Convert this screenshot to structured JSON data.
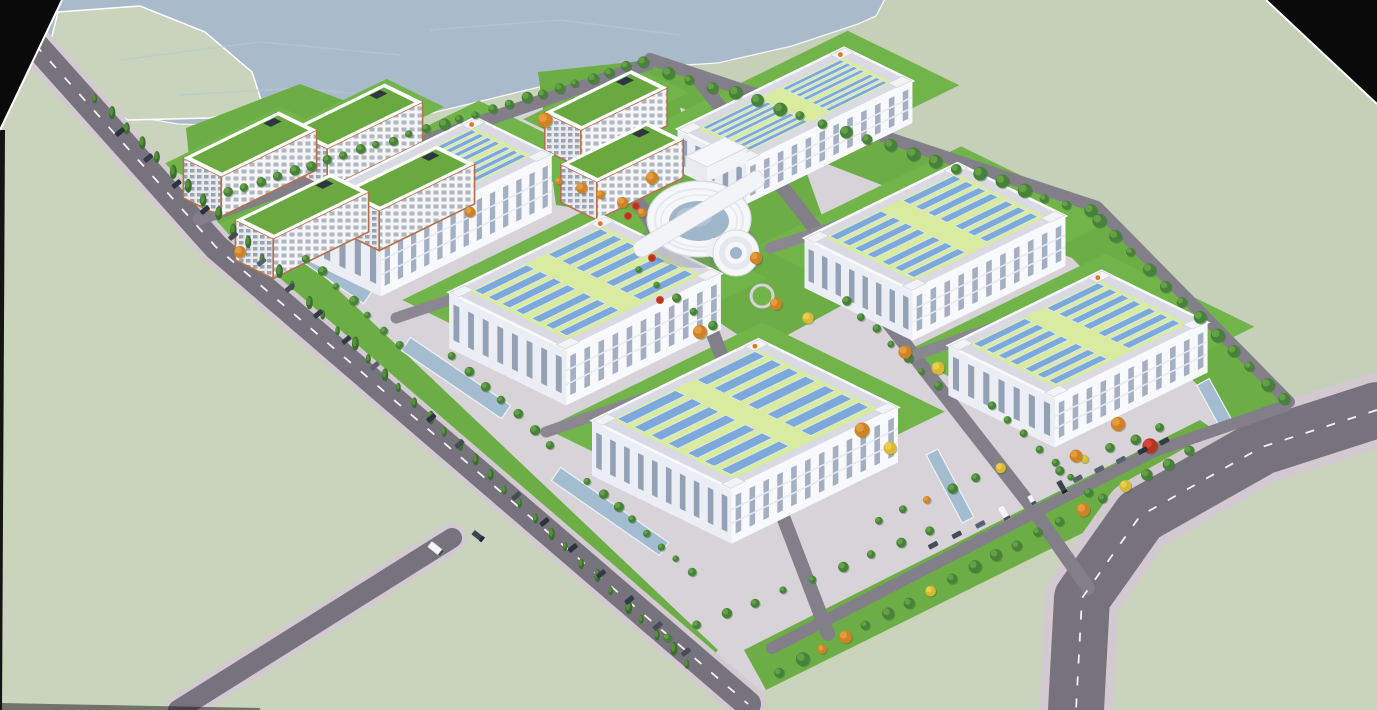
{
  "scene": {
    "description": "Aerial 3D architectural rendering of an industrial park: six white factory halls with rooftop solar arrays, dormitory blocks with green roofs, a circular hub building, tree-lined roads, water bodies and a curving highway",
    "canvas": {
      "w": 1377,
      "h": 710
    },
    "axes": {
      "u": [
        0.9,
        -0.44
      ],
      "v": [
        0.9,
        0.44
      ]
    },
    "colors": {
      "land": "#cad3bc",
      "landAlt": "#c6cfb8",
      "water": "#a9bbca",
      "ripple": "#b8c7d4",
      "shore": "#f5f7f8",
      "pavement": "#d7d3d8",
      "lawn": "#6cae45",
      "lawnBright": "#71b44a",
      "roadMain": "#76737d",
      "roadMinor": "#827f89",
      "roadLane": "#8a8791",
      "sidewalk": "#d2cad0",
      "dash": "#f2f2f4",
      "roofRim": "#d9dae3",
      "roofField": "#d9eb9e",
      "panel": "#7ca8da",
      "panelEdge": "#dce8f6",
      "wallLight": "#f8f9fc",
      "wallShade": "#eceef5",
      "windowSlit": "#9aa6bb",
      "windowSlit2": "#8b97ac",
      "parapet": "#fafafc",
      "cornerBlock": "#f2f3f7",
      "cornerEdge": "#cdd0da",
      "logoOrange": "#e07820",
      "floorBand": "#e8eaf1",
      "dormRoof": "#69a93f",
      "dormTrim": "#b5724a",
      "dormWin": "#aeb6c2",
      "dormWin2": "#9aa3b2",
      "dormWallA": "#f6f6f8",
      "dormWallB": "#e8eaf0",
      "roofUnit": "#2f3542",
      "glass": "#9fb5c8",
      "glassHi": "#b6c9da",
      "ringWhite": "#f6f7fa",
      "ringStroke": "#d5d8e2",
      "ringMid": "#e6e8ef",
      "channel": "#a4bcd0",
      "channelEdge": "#eef2f6",
      "treeGreen": "#47823a",
      "treeGreenLight": "#65a047",
      "conifer": "#3b6d2f",
      "coniferLight": "#549139",
      "orange": "#d08229",
      "orangeLight": "#e39d3c",
      "yellow": "#d9b832",
      "yellowLight": "#e7cf55",
      "red": "#b73325",
      "redLight": "#d24a33",
      "carPalette": [
        "#2c323e",
        "#454b57",
        "#5a6170",
        "#343a46"
      ],
      "truckWhite": "#f5f5f7",
      "truckDark": "#3a4150",
      "truckEdge": "#c2c4cc",
      "black": "#0a0a0a",
      "shadow": "#5a6478"
    },
    "water": {
      "outline": [
        [
          16,
          -3
        ],
        [
          886,
          -3
        ],
        [
          876,
          16
        ],
        [
          858,
          24
        ],
        [
          792,
          46
        ],
        [
          718,
          63
        ],
        [
          652,
          67
        ],
        [
          560,
          82
        ],
        [
          432,
          113
        ],
        [
          302,
          128
        ],
        [
          178,
          124
        ],
        [
          108,
          112
        ],
        [
          36,
          26
        ]
      ],
      "peninsula": [
        [
          58,
          12
        ],
        [
          140,
          6
        ],
        [
          205,
          32
        ],
        [
          252,
          72
        ],
        [
          263,
          106
        ],
        [
          210,
          118
        ],
        [
          128,
          120
        ],
        [
          80,
          96
        ],
        [
          48,
          52
        ]
      ],
      "ripples": [
        [
          [
            120,
            60
          ],
          [
            260,
            42
          ],
          [
            400,
            55
          ]
        ],
        [
          [
            430,
            30
          ],
          [
            560,
            20
          ],
          [
            680,
            35
          ]
        ],
        [
          [
            180,
            95
          ],
          [
            300,
            88
          ],
          [
            380,
            96
          ]
        ]
      ]
    },
    "blackCorners": {
      "tl": [
        [
          0,
          0
        ],
        [
          62,
          0
        ],
        [
          0,
          130
        ]
      ],
      "tr": [
        [
          1266,
          0
        ],
        [
          1377,
          0
        ],
        [
          1377,
          104
        ]
      ],
      "leftSliver": [
        [
          0,
          130
        ],
        [
          5,
          130
        ],
        [
          2,
          710
        ],
        [
          0,
          710
        ]
      ],
      "bottomSliver": [
        [
          0,
          703
        ],
        [
          260,
          708
        ],
        [
          260,
          710
        ],
        [
          0,
          710
        ]
      ]
    },
    "site": {
      "outline": [
        [
          197,
          214
        ],
        [
          648,
          57
        ],
        [
          1098,
          205
        ],
        [
          1290,
          402
        ],
        [
          762,
          692
        ]
      ]
    },
    "lawns": [
      {
        "name": "dorm-cluster-lawn",
        "pts": [
          [
            186,
            128
          ],
          [
            300,
            84
          ],
          [
            466,
            146
          ],
          [
            470,
            212
          ],
          [
            330,
            278
          ],
          [
            198,
            248
          ]
        ]
      },
      {
        "name": "mid-cluster-lawn",
        "pts": [
          [
            538,
            72
          ],
          [
            668,
            58
          ],
          [
            700,
            190
          ],
          [
            620,
            215
          ],
          [
            556,
            205
          ]
        ]
      },
      {
        "name": "center-lawn",
        "pts": [
          [
            622,
            150
          ],
          [
            795,
            140
          ],
          [
            852,
            300
          ],
          [
            760,
            350
          ],
          [
            640,
            268
          ]
        ]
      },
      {
        "name": "ne-strip-lawn",
        "pts": [
          [
            652,
            60
          ],
          [
            1098,
            207
          ],
          [
            1288,
            400
          ],
          [
            1248,
            436
          ],
          [
            1072,
            258
          ],
          [
            645,
            94
          ]
        ]
      },
      {
        "name": "se-strip-lawn",
        "pts": [
          [
            766,
            690
          ],
          [
            1246,
            452
          ],
          [
            1200,
            420
          ],
          [
            744,
            650
          ]
        ]
      },
      {
        "name": "west-strip-lawn",
        "pts": [
          [
            208,
            226
          ],
          [
            252,
            208
          ],
          [
            718,
            650
          ],
          [
            692,
            678
          ]
        ]
      }
    ],
    "warehouses": [
      {
        "c": [
          795,
          105
        ],
        "wu": 185,
        "hv": 76,
        "wallH": 42
      },
      {
        "c": [
          428,
          178
        ],
        "wu": 190,
        "hv": 85,
        "wallH": 58
      },
      {
        "c": [
          935,
          227
        ],
        "wu": 170,
        "hv": 120,
        "wallH": 50
      },
      {
        "c": [
          585,
          283
        ],
        "wu": 172,
        "hv": 130,
        "wallH": 56
      },
      {
        "c": [
          1078,
          334
        ],
        "wu": 170,
        "hv": 118,
        "wallH": 50
      },
      {
        "c": [
          745,
          414
        ],
        "wu": 185,
        "hv": 155,
        "wallH": 55
      }
    ],
    "dorms": [
      {
        "c": [
          606,
          100
        ],
        "wu": 96,
        "hv": 40,
        "wallH": 38
      },
      {
        "c": [
          356,
          116
        ],
        "wu": 106,
        "hv": 42,
        "wallH": 40
      },
      {
        "c": [
          250,
          144
        ],
        "wu": 106,
        "hv": 42,
        "wallH": 40
      },
      {
        "c": [
          622,
          152
        ],
        "wu": 96,
        "hv": 40,
        "wallH": 38
      },
      {
        "c": [
          408,
          178
        ],
        "wu": 106,
        "hv": 42,
        "wallH": 40
      },
      {
        "c": [
          302,
          206
        ],
        "wu": 106,
        "hv": 42,
        "wallH": 40
      }
    ],
    "utility": {
      "c": [
        716,
        152
      ],
      "wu": 44,
      "hv": 24,
      "wallH": 15
    },
    "centerBuilding": {
      "cx": 699,
      "cy": 219,
      "rx": 52,
      "ry": 38,
      "glassRx": 30,
      "glassRy": 20,
      "barAngle": -31,
      "barLen": 150,
      "barW": 17,
      "cyl": {
        "x": 736,
        "y": 253,
        "r": 23
      },
      "neck": [
        [
          712,
          238
        ],
        [
          734,
          243
        ],
        [
          728,
          266
        ],
        [
          704,
          253
        ]
      ]
    },
    "roundabout": {
      "x": 762,
      "y": 296,
      "r": 11
    },
    "channels": [
      {
        "p1": [
          272,
          231
        ],
        "p2": [
          368,
          297
        ],
        "w": 16
      },
      {
        "p1": [
          406,
          344
        ],
        "p2": [
          506,
          412
        ],
        "w": 16
      },
      {
        "p1": [
          556,
          474
        ],
        "p2": [
          664,
          549
        ],
        "w": 16
      },
      {
        "p1": [
          1203,
          382
        ],
        "p2": [
          1247,
          462
        ],
        "w": 14
      },
      {
        "p1": [
          932,
          452
        ],
        "p2": [
          968,
          520
        ],
        "w": 13
      }
    ],
    "roads": [
      {
        "name": "highway",
        "pts": [
          [
            1377,
            410
          ],
          [
            1262,
            447
          ],
          [
            1140,
            516
          ],
          [
            1082,
            598
          ],
          [
            1076,
            710
          ]
        ],
        "w": 56,
        "color": "roadMain",
        "dash": true,
        "sw": 74
      },
      {
        "name": "west-perimeter-road",
        "pts": [
          [
            6,
            12
          ],
          [
            216,
            247
          ],
          [
            748,
            704
          ]
        ],
        "w": 26,
        "color": "roadMain",
        "dash": true,
        "sw": 36
      },
      {
        "name": "southwest-branch-road",
        "pts": [
          [
            452,
            538
          ],
          [
            178,
            710
          ]
        ],
        "w": 20,
        "color": "roadMain",
        "dash": false,
        "sw": 30
      },
      {
        "name": "ne-perimeter-road",
        "pts": [
          [
            650,
            59
          ],
          [
            1097,
            207
          ],
          [
            1289,
            402
          ]
        ],
        "w": 12,
        "color": "roadMinor"
      },
      {
        "name": "se-service-lane",
        "pts": [
          [
            772,
            648
          ],
          [
            1152,
            452
          ],
          [
            1285,
            406
          ]
        ],
        "w": 12,
        "color": "roadMinor"
      },
      {
        "name": "nw-spine-road",
        "pts": [
          [
            199,
            219
          ],
          [
            648,
            64
          ]
        ],
        "w": 13,
        "color": "roadMinor"
      },
      {
        "name": "west-flank-road",
        "pts": [
          [
            576,
            104
          ],
          [
            700,
            300
          ],
          [
            828,
            634
          ]
        ],
        "w": 14,
        "color": "roadMinor"
      },
      {
        "name": "east-flank-road",
        "pts": [
          [
            699,
            80
          ],
          [
            1028,
            502
          ],
          [
            1088,
            588
          ]
        ],
        "w": 14,
        "color": "roadMinor"
      },
      {
        "name": "cross-road-1",
        "pts": [
          [
            396,
            318
          ],
          [
            622,
            242
          ]
        ],
        "w": 11,
        "color": "roadLane"
      },
      {
        "name": "cross-road-2",
        "pts": [
          [
            546,
            432
          ],
          [
            768,
            356
          ]
        ],
        "w": 11,
        "color": "roadLane"
      },
      {
        "name": "cross-road-3",
        "pts": [
          [
            770,
            248
          ],
          [
            958,
            186
          ]
        ],
        "w": 11,
        "color": "roadLane"
      },
      {
        "name": "cross-road-4",
        "pts": [
          [
            915,
            355
          ],
          [
            1100,
            290
          ]
        ],
        "w": 11,
        "color": "roadLane"
      }
    ],
    "treeRows": [
      {
        "p1": [
          96,
          98
        ],
        "p2": [
          688,
          664
        ],
        "n": 40,
        "r": 5,
        "kind": "c"
      },
      {
        "p1": [
          228,
          192
        ],
        "p2": [
          642,
          62
        ],
        "n": 26,
        "r": 4.5,
        "kind": "g"
      },
      {
        "p1": [
          668,
          72
        ],
        "p2": [
          1090,
          212
        ],
        "n": 20,
        "r": 5.5,
        "kind": "g"
      },
      {
        "p1": [
          1098,
          220
        ],
        "p2": [
          1284,
          400
        ],
        "n": 12,
        "r": 5.5,
        "kind": "g"
      },
      {
        "p1": [
          780,
          672
        ],
        "p2": [
          1190,
          452
        ],
        "n": 20,
        "r": 5.5,
        "kind": "m"
      },
      {
        "p1": [
          306,
          258
        ],
        "p2": [
          400,
          344
        ],
        "n": 7,
        "r": 4,
        "kind": "g"
      },
      {
        "p1": [
          452,
          356
        ],
        "p2": [
          550,
          444
        ],
        "n": 7,
        "r": 4,
        "kind": "g"
      },
      {
        "p1": [
          588,
          482
        ],
        "p2": [
          692,
          572
        ],
        "n": 8,
        "r": 4,
        "kind": "g"
      },
      {
        "p1": [
          846,
          302
        ],
        "p2": [
          938,
          386
        ],
        "n": 7,
        "r": 4,
        "kind": "g"
      },
      {
        "p1": [
          992,
          406
        ],
        "p2": [
          1088,
          492
        ],
        "n": 7,
        "r": 4,
        "kind": "g"
      },
      {
        "p1": [
          668,
          638
        ],
        "p2": [
          930,
          532
        ],
        "n": 10,
        "r": 4.5,
        "kind": "g"
      },
      {
        "p1": [
          880,
          520
        ],
        "p2": [
          1000,
          468
        ],
        "n": 6,
        "r": 4.5,
        "kind": "m"
      },
      {
        "p1": [
          1060,
          470
        ],
        "p2": [
          1160,
          428
        ],
        "n": 5,
        "r": 4.5,
        "kind": "m"
      },
      {
        "p1": [
          560,
          180
        ],
        "p2": [
          642,
          212
        ],
        "n": 5,
        "r": 4.5,
        "kind": "o"
      },
      {
        "p1": [
          640,
          270
        ],
        "p2": [
          712,
          326
        ],
        "n": 5,
        "r": 4,
        "kind": "g"
      }
    ],
    "singleTrees": [
      {
        "x": 756,
        "y": 258,
        "k": "o"
      },
      {
        "x": 776,
        "y": 304,
        "k": "o"
      },
      {
        "x": 808,
        "y": 318,
        "k": "y"
      },
      {
        "x": 545,
        "y": 120,
        "k": "o"
      },
      {
        "x": 652,
        "y": 178,
        "k": "o"
      },
      {
        "x": 905,
        "y": 352,
        "k": "o"
      },
      {
        "x": 938,
        "y": 368,
        "k": "y"
      },
      {
        "x": 1118,
        "y": 424,
        "k": "o"
      },
      {
        "x": 1150,
        "y": 446,
        "k": "r"
      },
      {
        "x": 862,
        "y": 430,
        "k": "o"
      },
      {
        "x": 890,
        "y": 448,
        "k": "y"
      },
      {
        "x": 240,
        "y": 252,
        "k": "o"
      },
      {
        "x": 470,
        "y": 212,
        "k": "o"
      },
      {
        "x": 700,
        "y": 332,
        "k": "o"
      },
      {
        "x": 1076,
        "y": 456,
        "k": "o"
      }
    ],
    "redBushes": [
      [
        636,
        206
      ],
      [
        652,
        258
      ],
      [
        628,
        216
      ],
      [
        660,
        300
      ]
    ],
    "parkingRows": [
      {
        "p1": [
          120,
          132
        ],
        "p2": [
          686,
          652
        ],
        "n": 21,
        "angle": -40,
        "l": 10,
        "w": 5
      },
      {
        "p1": [
          886,
          566
        ],
        "p2": [
          1004,
          514
        ],
        "n": 6,
        "angle": -28,
        "l": 10,
        "w": 5
      },
      {
        "p1": [
          1056,
          488
        ],
        "p2": [
          1186,
          432
        ],
        "n": 7,
        "angle": -28,
        "l": 10,
        "w": 5
      }
    ],
    "trucks": [
      {
        "x": 436,
        "y": 549,
        "a": 38,
        "l": 16,
        "w": 7,
        "dark": false
      },
      {
        "x": 478,
        "y": 536,
        "a": 38,
        "l": 13,
        "w": 6,
        "dark": true
      },
      {
        "x": 1004,
        "y": 513,
        "a": 60,
        "l": 15,
        "w": 7,
        "dark": false
      },
      {
        "x": 1062,
        "y": 487,
        "a": 60,
        "l": 14,
        "w": 6,
        "dark": true
      },
      {
        "x": 1032,
        "y": 500,
        "a": 60,
        "l": 10,
        "w": 5,
        "dark": false
      }
    ]
  }
}
